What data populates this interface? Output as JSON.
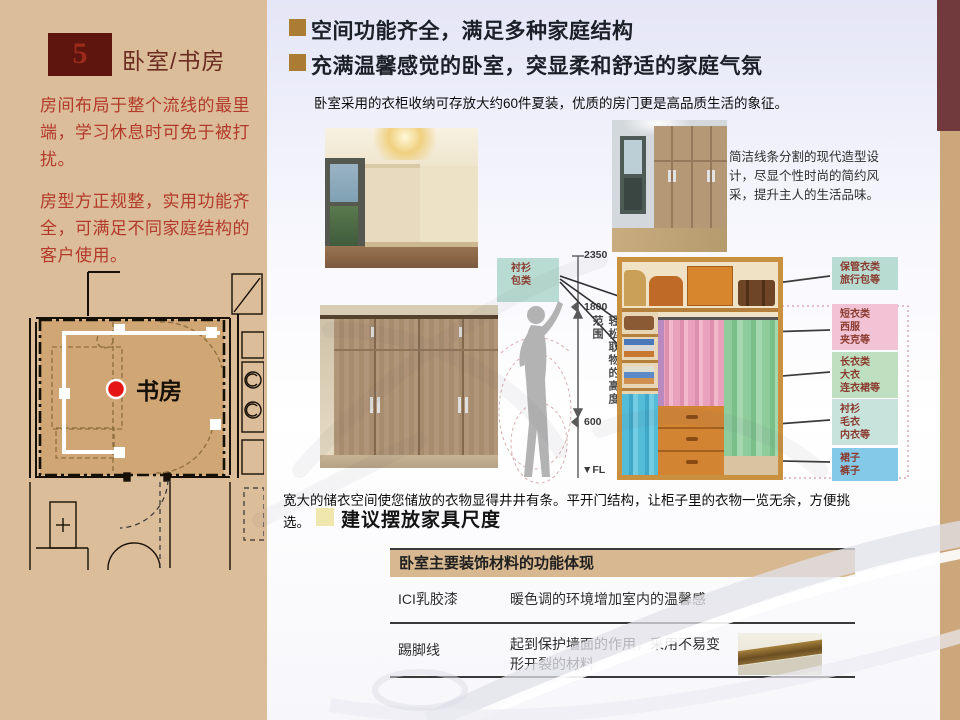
{
  "page": {
    "number": "5",
    "section_title": "卧室/书房"
  },
  "sidebar": {
    "paragraph1": "房间布局于整个流线的最里端，学习休息时可免于被打扰。",
    "paragraph2": "房型方正规整，实用功能齐全，可满足不同家庭结构的客户使用。",
    "floorplan_room_label": "书房"
  },
  "headings": {
    "h1": "空间功能齐全，满足多种家庭结构",
    "h2": "充满温馨感觉的卧室，突显柔和舒适的家庭气氛",
    "intro": "卧室采用的衣柜收纳可存放大约60件夏装，优质的房门更是高品质生活的象征。"
  },
  "wardrobe_note": "简洁线条分割的现代造型设计，尽显个性时尚的简约风采，提升主人的生活品味。",
  "diagram": {
    "dims": {
      "top": "2350",
      "upper": "1800",
      "lower": "600",
      "floor": "▼FL"
    },
    "reach_label": "轻松取物的高度范围",
    "left_label": {
      "line1": "衬衫",
      "line2": "包类"
    },
    "right_labels": [
      {
        "l1": "保管衣类",
        "l2": "旅行包等",
        "l3": ""
      },
      {
        "l1": "短衣类",
        "l2": "西服",
        "l3": "夹克等"
      },
      {
        "l1": "长衣类",
        "l2": "大衣",
        "l3": "连衣裙等"
      },
      {
        "l1": "衬衫",
        "l2": "毛衣",
        "l3": "内衣等"
      },
      {
        "l1": "裙子",
        "l2": "裤子",
        "l3": ""
      }
    ]
  },
  "storage": {
    "line1": "宽大的储衣空间使您储放的衣物显得井井有条。平开门结构，让柜子里的衣物一览无余，方便挑",
    "line2": "选。"
  },
  "suggestion_heading": "建议摆放家具尺度",
  "table": {
    "header": "卧室主要装饰材料的功能体现",
    "rows": [
      {
        "material": "ICI乳胶漆",
        "desc": "暖色调的环境增加室内的温馨感"
      },
      {
        "material": "踢脚线",
        "desc": "起到保护墙面的作用，采用不易变形开裂的材料"
      }
    ]
  },
  "colors": {
    "sidebar_tan": "#dcbd99",
    "right_bar_tan": "#cda77c",
    "corner_maroon": "#713a3d",
    "number_box_maroon": "#5e150e",
    "sidebar_text_red": "#b23a2b",
    "heading_bullet_gold": "#ab7c33",
    "suggestion_bullet_yellow": "#efe7ad",
    "table_header_tan": "#d7b890",
    "label_teal": "#b9dcd2",
    "label_pink": "#f2c3d4",
    "label_green": "#bedfc0",
    "label_lightteal": "#c8e2dc",
    "label_blue": "#85c9e8",
    "route_marker_red": "#e51515"
  }
}
